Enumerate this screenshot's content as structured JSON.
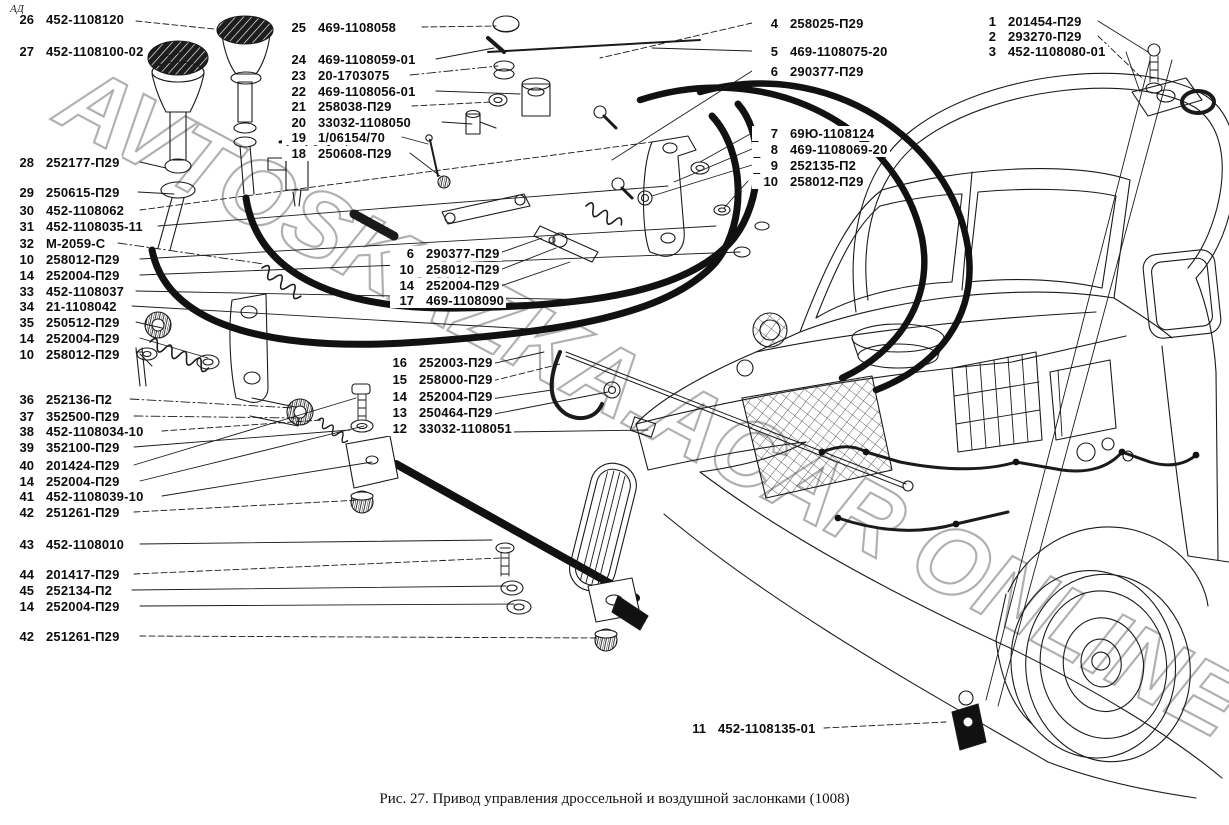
{
  "figure": {
    "corner_mark": "АД",
    "caption": "Рис. 27. Привод управления дроссельной и воздушной заслонками (1008)",
    "watermark": "AVTOSKAZKA.ACAR ONLINE"
  },
  "callouts": {
    "groups": [
      {
        "id": "left-column",
        "x": 8,
        "num_w": 24,
        "rows": [
          {
            "n": "26",
            "p": "452-1108120",
            "y": 12
          },
          {
            "n": "27",
            "p": "452-1108100-02",
            "y": 44
          },
          {
            "n": "28",
            "p": "252177-П29",
            "y": 155
          },
          {
            "n": "29",
            "p": "250615-П29",
            "y": 185
          },
          {
            "n": "30",
            "p": "452-1108062",
            "y": 203
          },
          {
            "n": "31",
            "p": "452-1108035-11",
            "y": 219
          },
          {
            "n": "32",
            "p": "М-2059-С",
            "y": 236
          },
          {
            "n": "10",
            "p": "258012-П29",
            "y": 252
          },
          {
            "n": "14",
            "p": "252004-П29",
            "y": 268
          },
          {
            "n": "33",
            "p": "452-1108037",
            "y": 284
          },
          {
            "n": "34",
            "p": "21-1108042",
            "y": 299
          },
          {
            "n": "35",
            "p": "250512-П29",
            "y": 315
          },
          {
            "n": "14",
            "p": "252004-П29",
            "y": 331
          },
          {
            "n": "10",
            "p": "258012-П29",
            "y": 347
          },
          {
            "n": "36",
            "p": "252136-П2",
            "y": 392
          },
          {
            "n": "37",
            "p": "352500-П29",
            "y": 409
          },
          {
            "n": "38",
            "p": "452-1108034-10",
            "y": 424
          },
          {
            "n": "39",
            "p": "352100-П29",
            "y": 440
          },
          {
            "n": "40",
            "p": "201424-П29",
            "y": 458
          },
          {
            "n": "14",
            "p": "252004-П29",
            "y": 474
          },
          {
            "n": "41",
            "p": "452-1108039-10",
            "y": 489
          },
          {
            "n": "42",
            "p": "251261-П29",
            "y": 505
          },
          {
            "n": "43",
            "p": "452-1108010",
            "y": 537
          },
          {
            "n": "44",
            "p": "201417-П29",
            "y": 567
          },
          {
            "n": "45",
            "p": "252134-П2",
            "y": 583
          },
          {
            "n": "14",
            "p": "252004-П29",
            "y": 599
          },
          {
            "n": "42",
            "p": "251261-П29",
            "y": 629
          }
        ]
      },
      {
        "id": "middle-top-column",
        "x": 282,
        "num_w": 22,
        "rows": [
          {
            "n": "25",
            "p": "469-1108058",
            "y": 20
          },
          {
            "n": "24",
            "p": "469-1108059-01",
            "y": 52
          },
          {
            "n": "23",
            "p": "20-1703075",
            "y": 68
          },
          {
            "n": "22",
            "p": "469-1108056-01",
            "y": 84
          },
          {
            "n": "21",
            "p": "258038-П29",
            "y": 99
          },
          {
            "n": "20",
            "p": "33032-1108050",
            "y": 115
          },
          {
            "n": "19",
            "p": "1/06154/70",
            "y": 130
          },
          {
            "n": "18",
            "p": "250608-П29",
            "y": 146
          }
        ]
      },
      {
        "id": "middle-group-upper",
        "x": 390,
        "num_w": 22,
        "rows": [
          {
            "n": "6",
            "p": "290377-П29",
            "y": 246
          },
          {
            "n": "10",
            "p": "258012-П29",
            "y": 262
          },
          {
            "n": "14",
            "p": "252004-П29",
            "y": 278
          },
          {
            "n": "17",
            "p": "469-1108090",
            "y": 293
          }
        ]
      },
      {
        "id": "middle-group-lower",
        "x": 383,
        "num_w": 22,
        "rows": [
          {
            "n": "16",
            "p": "252003-П29",
            "y": 355
          },
          {
            "n": "15",
            "p": "258000-П29",
            "y": 372
          },
          {
            "n": "14",
            "p": "252004-П29",
            "y": 389
          },
          {
            "n": "13",
            "p": "250464-П29",
            "y": 405
          },
          {
            "n": "12",
            "p": "33032-1108051",
            "y": 421
          }
        ]
      },
      {
        "id": "right-column",
        "x": 752,
        "num_w": 24,
        "rows": [
          {
            "n": "4",
            "p": "258025-П29",
            "y": 16
          },
          {
            "n": "5",
            "p": "469-1108075-20",
            "y": 44
          },
          {
            "n": "6",
            "p": "290377-П29",
            "y": 64
          },
          {
            "n": "7",
            "p": "69Ю-1108124",
            "y": 126
          },
          {
            "n": "8",
            "p": "469-1108069-20",
            "y": 142
          },
          {
            "n": "9",
            "p": "252135-П2",
            "y": 158
          },
          {
            "n": "10",
            "p": "258012-П29",
            "y": 174
          }
        ]
      },
      {
        "id": "far-right-column",
        "x": 978,
        "num_w": 16,
        "rows": [
          {
            "n": "1",
            "p": "201454-П29",
            "y": 14
          },
          {
            "n": "2",
            "p": "293270-П29",
            "y": 29
          },
          {
            "n": "3",
            "p": "452-1108080-01",
            "y": 44
          }
        ]
      },
      {
        "id": "bottom-label",
        "x": 684,
        "num_w": 20,
        "rows": [
          {
            "n": "11",
            "p": "452-1108135-01",
            "y": 721
          }
        ]
      }
    ]
  }
}
